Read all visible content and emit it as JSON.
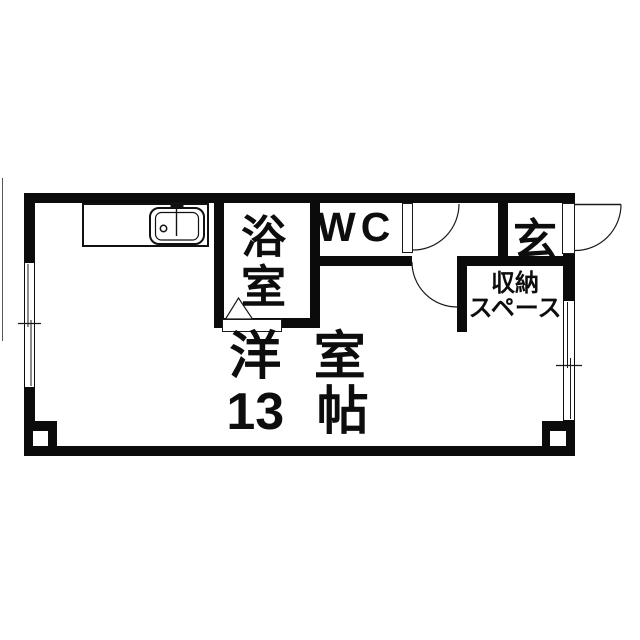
{
  "plan": {
    "rooms": {
      "bathroom": {
        "label": "浴室"
      },
      "toilet": {
        "label": "WC"
      },
      "entrance": {
        "label": "玄"
      },
      "storage": {
        "line1": "収納",
        "line2": "スペース"
      },
      "living": {
        "name": "洋 室",
        "area": "13 帖"
      }
    },
    "symbols": {
      "kitchen_sink": "sink-with-faucet-icon",
      "swing_doors": "quarter-arc-door-icon",
      "bath_door": "folding-door-triangle-icon",
      "windows": "double-line-sliding-window-icon",
      "pillars": "corner-pillar-icon"
    },
    "colors": {
      "wall": "#0b0b0b",
      "line": "#1a1a1a",
      "background": "#ffffff"
    }
  }
}
